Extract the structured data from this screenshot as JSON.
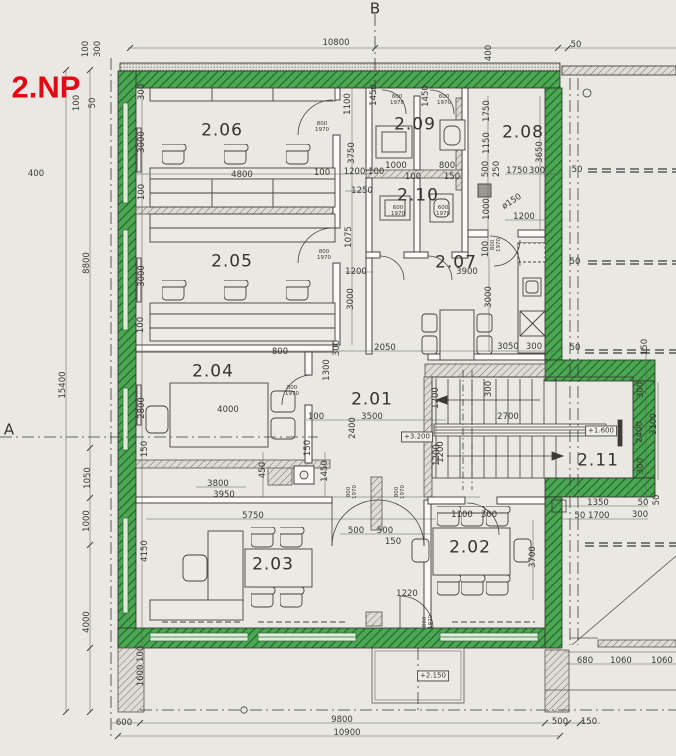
{
  "title": {
    "text": "2.NP",
    "color": "#e30613"
  },
  "wall_colors": {
    "new_masonry_highlight": "#4ea556",
    "hatch_line": "#17701f",
    "existing": "#74716a"
  },
  "axes": [
    {
      "t": "B",
      "x": 375,
      "y": 9
    },
    {
      "t": "A",
      "x": 9,
      "y": 430
    }
  ],
  "rooms": [
    {
      "t": "2.06",
      "x": 222,
      "y": 131
    },
    {
      "t": "2.09",
      "x": 415,
      "y": 125
    },
    {
      "t": "2.08",
      "x": 523,
      "y": 133
    },
    {
      "t": "2.10",
      "x": 418,
      "y": 196
    },
    {
      "t": "2.05",
      "x": 232,
      "y": 262
    },
    {
      "t": "2.07",
      "x": 456,
      "y": 263
    },
    {
      "t": "2.04",
      "x": 213,
      "y": 372
    },
    {
      "t": "2.01",
      "x": 372,
      "y": 400
    },
    {
      "t": "2.11",
      "x": 598,
      "y": 461
    },
    {
      "t": "2.02",
      "x": 470,
      "y": 548
    },
    {
      "t": "2.03",
      "x": 273,
      "y": 565
    }
  ],
  "elevations": [
    {
      "t": "+3.200",
      "x": 417,
      "y": 437
    },
    {
      "t": "+1.600",
      "x": 601,
      "y": 431
    },
    {
      "t": "+2.150",
      "x": 433,
      "y": 676
    }
  ],
  "door_labels": [
    {
      "t": "800\n1970",
      "x": 322,
      "y": 128
    },
    {
      "t": "800\n1970",
      "x": 324,
      "y": 256
    },
    {
      "t": "800\n1970",
      "x": 292,
      "y": 392
    },
    {
      "t": "800\n1970",
      "x": 353,
      "y": 492,
      "r": 90
    },
    {
      "t": "800\n1970",
      "x": 401,
      "y": 492,
      "r": 90
    },
    {
      "t": "800\n1970",
      "x": 497,
      "y": 245,
      "r": 90
    },
    {
      "t": "800\n1970",
      "x": 429,
      "y": 622,
      "r": 90
    },
    {
      "t": "600\n1970",
      "x": 397,
      "y": 101
    },
    {
      "t": "600\n1970",
      "x": 444,
      "y": 101
    },
    {
      "t": "600\n1970",
      "x": 398,
      "y": 212
    },
    {
      "t": "600\n1970",
      "x": 443,
      "y": 212
    }
  ],
  "dimensions": [
    {
      "t": "10800",
      "x": 336,
      "y": 43
    },
    {
      "t": "400",
      "x": 489,
      "y": 53,
      "r": 90
    },
    {
      "t": "50",
      "x": 576,
      "y": 45
    },
    {
      "t": "100",
      "x": 86,
      "y": 49,
      "r": 90
    },
    {
      "t": "300",
      "x": 98,
      "y": 49,
      "r": 90
    },
    {
      "t": "100",
      "x": 77,
      "y": 103,
      "r": 90
    },
    {
      "t": "50",
      "x": 93,
      "y": 103,
      "r": 90
    },
    {
      "t": "400",
      "x": 36,
      "y": 174
    },
    {
      "t": "15400",
      "x": 63,
      "y": 385,
      "r": 90
    },
    {
      "t": "8800",
      "x": 87,
      "y": 263,
      "r": 90
    },
    {
      "t": "1050",
      "x": 88,
      "y": 478,
      "r": 90
    },
    {
      "t": "1000",
      "x": 87,
      "y": 521,
      "r": 90
    },
    {
      "t": "4000",
      "x": 87,
      "y": 622,
      "r": 90
    },
    {
      "t": "300",
      "x": 142,
      "y": 92,
      "r": 90
    },
    {
      "t": "3000",
      "x": 142,
      "y": 142,
      "r": 90
    },
    {
      "t": "100",
      "x": 142,
      "y": 192,
      "r": 90
    },
    {
      "t": "3000",
      "x": 142,
      "y": 276,
      "r": 90
    },
    {
      "t": "100",
      "x": 141,
      "y": 325,
      "r": 90
    },
    {
      "t": "2800",
      "x": 142,
      "y": 408,
      "r": 90
    },
    {
      "t": "150",
      "x": 145,
      "y": 449,
      "r": 90
    },
    {
      "t": "4150",
      "x": 145,
      "y": 551,
      "r": 90
    },
    {
      "t": "1600 100",
      "x": 141,
      "y": 666,
      "r": 90
    },
    {
      "t": "4800",
      "x": 242,
      "y": 175
    },
    {
      "t": "100",
      "x": 322,
      "y": 173
    },
    {
      "t": "1200 100",
      "x": 364,
      "y": 172
    },
    {
      "t": "1100",
      "x": 348,
      "y": 104,
      "r": 90
    },
    {
      "t": "3750",
      "x": 352,
      "y": 153,
      "r": 90
    },
    {
      "t": "1250",
      "x": 362,
      "y": 191
    },
    {
      "t": "1075",
      "x": 349,
      "y": 237,
      "r": 90
    },
    {
      "t": "1200",
      "x": 356,
      "y": 272
    },
    {
      "t": "3000",
      "x": 351,
      "y": 299,
      "r": 90
    },
    {
      "t": "1450",
      "x": 374,
      "y": 95,
      "r": 90
    },
    {
      "t": "1450",
      "x": 426,
      "y": 96,
      "r": 90
    },
    {
      "t": "1750",
      "x": 487,
      "y": 111,
      "r": 90
    },
    {
      "t": "1150",
      "x": 487,
      "y": 143,
      "r": 90
    },
    {
      "t": "500",
      "x": 486,
      "y": 169,
      "r": 90
    },
    {
      "t": "250",
      "x": 497,
      "y": 169,
      "r": 90
    },
    {
      "t": "1750",
      "x": 517,
      "y": 171
    },
    {
      "t": "300",
      "x": 537,
      "y": 171
    },
    {
      "t": "3650",
      "x": 540,
      "y": 152,
      "r": 90
    },
    {
      "t": "1000",
      "x": 396,
      "y": 166
    },
    {
      "t": "100",
      "x": 413,
      "y": 177
    },
    {
      "t": "800",
      "x": 447,
      "y": 166
    },
    {
      "t": "150",
      "x": 452,
      "y": 177
    },
    {
      "t": "1000",
      "x": 487,
      "y": 209,
      "r": 90
    },
    {
      "t": "ø150",
      "x": 512,
      "y": 202,
      "r": 33
    },
    {
      "t": "1200",
      "x": 524,
      "y": 217
    },
    {
      "t": "100",
      "x": 486,
      "y": 249,
      "r": 90
    },
    {
      "t": "3900",
      "x": 467,
      "y": 272
    },
    {
      "t": "3000",
      "x": 489,
      "y": 297,
      "r": 90
    },
    {
      "t": "2050",
      "x": 385,
      "y": 348
    },
    {
      "t": "300",
      "x": 337,
      "y": 348,
      "r": 90
    },
    {
      "t": "3050",
      "x": 508,
      "y": 347
    },
    {
      "t": "300",
      "x": 534,
      "y": 347
    },
    {
      "t": "800",
      "x": 280,
      "y": 352
    },
    {
      "t": "1300",
      "x": 327,
      "y": 370,
      "r": 90
    },
    {
      "t": "4000",
      "x": 228,
      "y": 410
    },
    {
      "t": "100",
      "x": 316,
      "y": 417
    },
    {
      "t": "3500",
      "x": 372,
      "y": 417
    },
    {
      "t": "2400",
      "x": 353,
      "y": 428,
      "r": 90
    },
    {
      "t": "150",
      "x": 308,
      "y": 448,
      "r": 90
    },
    {
      "t": "450",
      "x": 263,
      "y": 470,
      "r": 90
    },
    {
      "t": "1450",
      "x": 325,
      "y": 471,
      "r": 90
    },
    {
      "t": "3800",
      "x": 218,
      "y": 484
    },
    {
      "t": "3950",
      "x": 224,
      "y": 495
    },
    {
      "t": "5750",
      "x": 253,
      "y": 516
    },
    {
      "t": "500",
      "x": 356,
      "y": 531
    },
    {
      "t": "500",
      "x": 385,
      "y": 531
    },
    {
      "t": "150",
      "x": 393,
      "y": 542
    },
    {
      "t": "1200",
      "x": 436,
      "y": 398,
      "r": 90
    },
    {
      "t": "300",
      "x": 489,
      "y": 389,
      "r": 90
    },
    {
      "t": "2700",
      "x": 508,
      "y": 417
    },
    {
      "t": "1200",
      "x": 437,
      "y": 455,
      "r": 90
    },
    {
      "t": "1200",
      "x": 441,
      "y": 452,
      "r": 90
    },
    {
      "t": "2400",
      "x": 640,
      "y": 432,
      "r": 90
    },
    {
      "t": "3100",
      "x": 654,
      "y": 424,
      "r": 90
    },
    {
      "t": "300",
      "x": 641,
      "y": 390,
      "r": 90
    },
    {
      "t": "300",
      "x": 641,
      "y": 466,
      "r": 90
    },
    {
      "t": "1350",
      "x": 598,
      "y": 503
    },
    {
      "t": "50 1700",
      "x": 592,
      "y": 516
    },
    {
      "t": "50",
      "x": 643,
      "y": 503
    },
    {
      "t": "300",
      "x": 640,
      "y": 515
    },
    {
      "t": "50",
      "x": 657,
      "y": 500,
      "r": 90
    },
    {
      "t": "150",
      "x": 645,
      "y": 347,
      "r": 90
    },
    {
      "t": "50",
      "x": 575,
      "y": 348
    },
    {
      "t": "50",
      "x": 577,
      "y": 170
    },
    {
      "t": "50",
      "x": 575,
      "y": 262
    },
    {
      "t": "1220",
      "x": 407,
      "y": 594
    },
    {
      "t": "3700",
      "x": 533,
      "y": 557,
      "r": 90
    },
    {
      "t": "300",
      "x": 489,
      "y": 515
    },
    {
      "t": "1100",
      "x": 462,
      "y": 515
    },
    {
      "t": "680",
      "x": 585,
      "y": 661
    },
    {
      "t": "1060",
      "x": 621,
      "y": 661
    },
    {
      "t": "1060",
      "x": 662,
      "y": 661
    },
    {
      "t": "600",
      "x": 124,
      "y": 723
    },
    {
      "t": "9800",
      "x": 342,
      "y": 720
    },
    {
      "t": "10900",
      "x": 347,
      "y": 733
    },
    {
      "t": "500",
      "x": 560,
      "y": 722
    },
    {
      "t": "150",
      "x": 589,
      "y": 722
    }
  ]
}
